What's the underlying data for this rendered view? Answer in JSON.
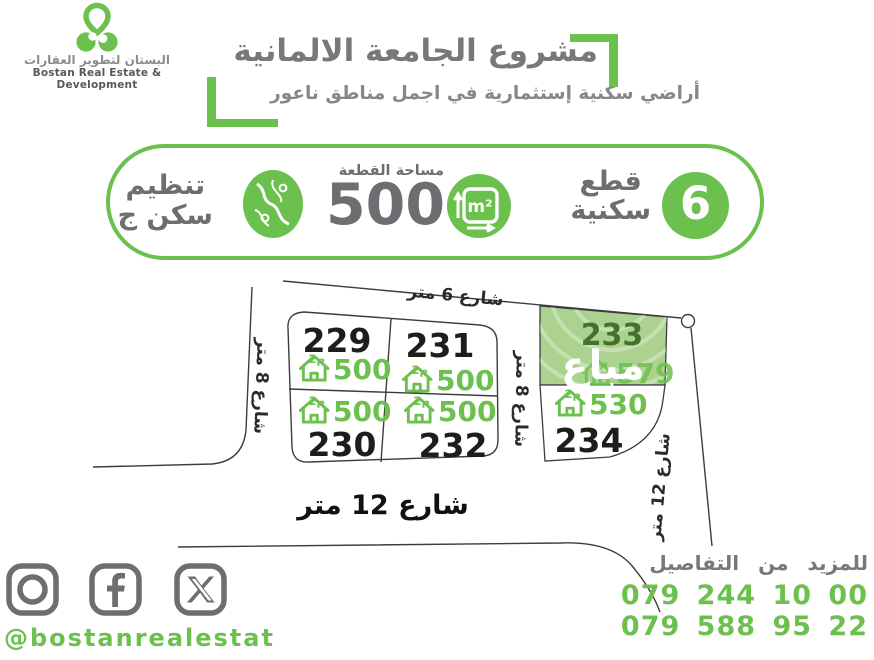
{
  "brand": {
    "logo_text_ar": "البستان لتطوير العقارات",
    "logo_text_en": "Bostan Real Estate & Development",
    "logo_icon": "clover-pin-icon"
  },
  "header": {
    "title": "مشروع الجامعة الالمانية",
    "subtitle": "أراضي سكنية إستثمارية في اجمل مناطق ناعور"
  },
  "banner": {
    "plots_count": "6",
    "plots_label_line1": "قطع",
    "plots_label_line2": "سكنية",
    "area_label": "مساحة القطعة",
    "area_value": "500",
    "m2_label": "m²",
    "measure_icon": "square-meter-measure-icon",
    "zoning_icon": "zoning-map-icon",
    "zoning_line1": "تنظيم",
    "zoning_line2": "سكن ج"
  },
  "map": {
    "streets": {
      "top": "شارع 6 متر",
      "left": "شارع 8 متر",
      "middle": "شارع 8 متر",
      "bottom": "شارع 12 متر",
      "right": "شارع 12 متر"
    },
    "area_unit": "م2",
    "plots": [
      {
        "number": "229",
        "area": "500",
        "sold": false
      },
      {
        "number": "231",
        "area": "500",
        "sold": false
      },
      {
        "number": "233",
        "area": "579",
        "sold": true,
        "sold_label": "مباع"
      },
      {
        "number": "230",
        "area": "500",
        "sold": false
      },
      {
        "number": "232",
        "area": "500",
        "sold": false
      },
      {
        "number": "234",
        "area": "530",
        "sold": false
      }
    ]
  },
  "footer": {
    "icons": [
      "instagram-icon",
      "facebook-icon",
      "x-icon"
    ],
    "social_handle": "@bostanrealestat",
    "details_label": "للمزيد من التفاصيل",
    "phone1": "079 244 10 00",
    "phone2": "079 588 95 22"
  },
  "colors": {
    "accent_green": "#6cc04d",
    "sold_fill_green": "#abd28f",
    "sold_number_green": "#44722e",
    "gray_text": "#77787b",
    "icon_gray": "#6d6e71",
    "line_color": "#3d3d3d"
  }
}
